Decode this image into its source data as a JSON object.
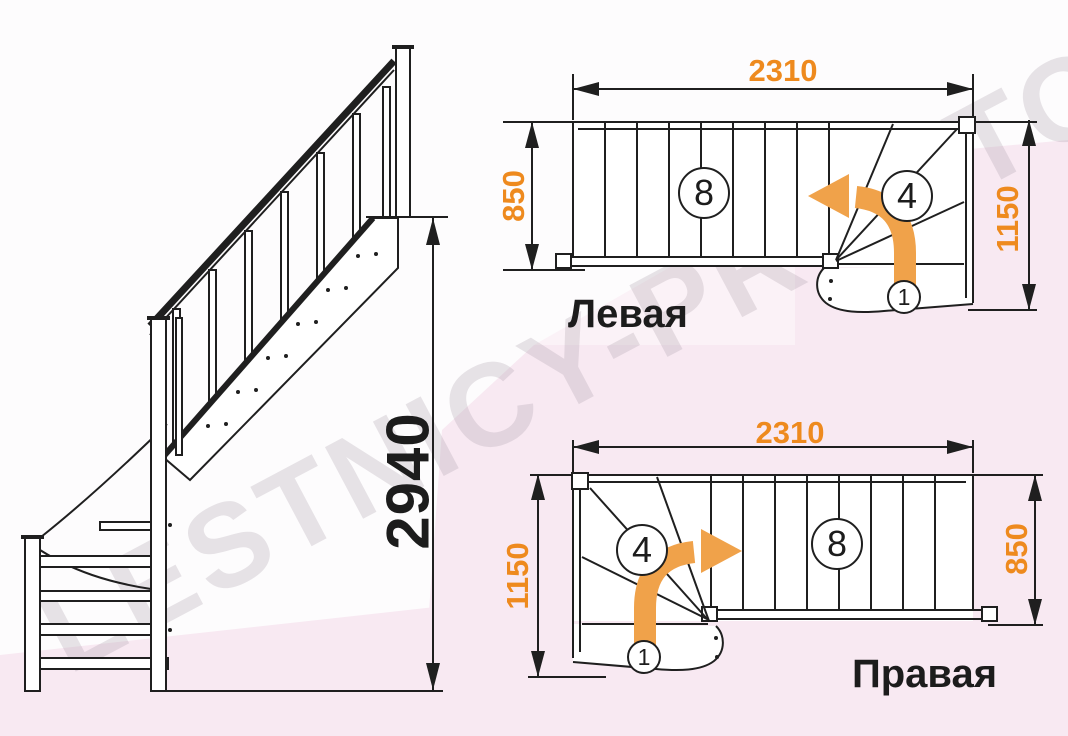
{
  "watermark": {
    "text": "LESTNICY-PROSTO.RU"
  },
  "colors": {
    "dimension_orange": "#EE8A1E",
    "arrow_orange": "#F0A24A",
    "line_dark": "#1F1F1F",
    "background_pink": "#F8E9F2"
  },
  "side_view": {
    "total_height": "2940"
  },
  "plan_left": {
    "label": "Левая",
    "length": "2310",
    "flight_width": "850",
    "turn_width": "1150",
    "straight_steps": "8",
    "winder_steps": "4",
    "first_step": "1"
  },
  "plan_right": {
    "label": "Правая",
    "length": "2310",
    "flight_width": "850",
    "turn_width": "1150",
    "straight_steps": "8",
    "winder_steps": "4",
    "first_step": "1"
  }
}
